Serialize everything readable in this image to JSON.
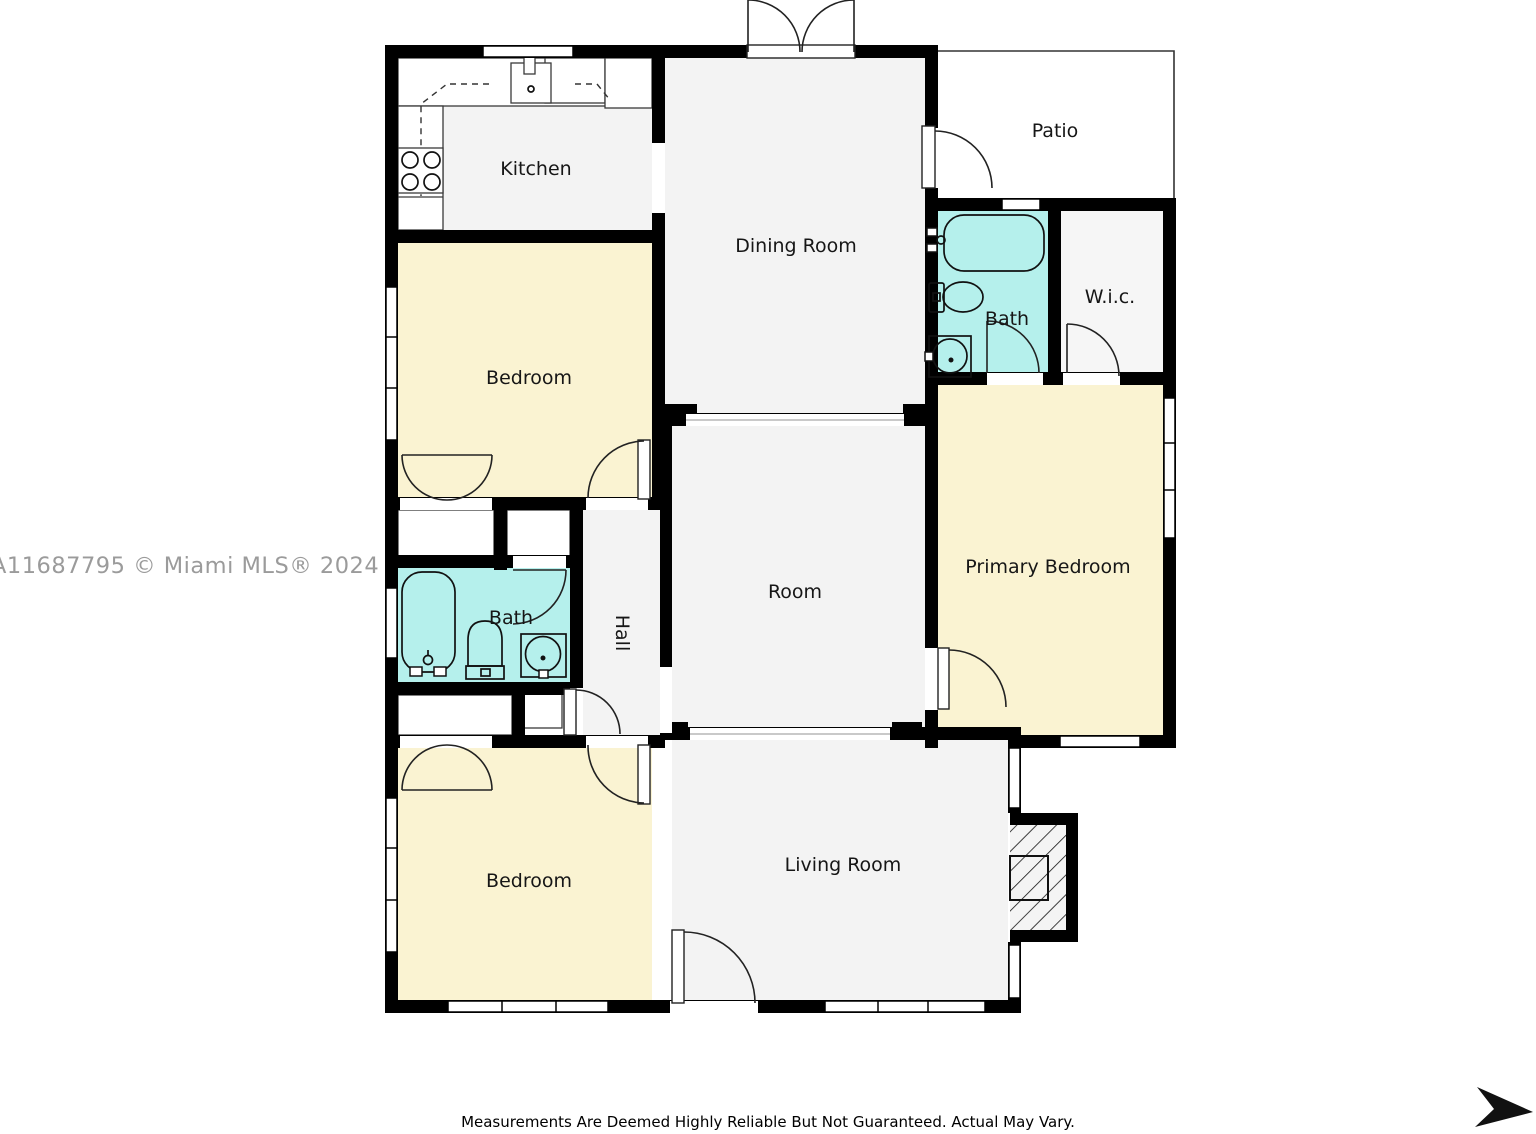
{
  "watermark": "A11687795 © Miami MLS® 2024",
  "disclaimer": "Measurements Are Deemed Highly Reliable But Not Guaranteed. Actual May Vary.",
  "rooms": {
    "kitchen": "Kitchen",
    "dining_room": "Dining Room",
    "patio": "Patio",
    "bath_upper": "Bath",
    "wic": "W.i.c.",
    "bedroom_upper": "Bedroom",
    "primary_bedroom": "Primary Bedroom",
    "room": "Room",
    "bath_lower": "Bath",
    "hall": "Hall",
    "bedroom_lower": "Bedroom",
    "living_room": "Living Room"
  },
  "icons": {
    "stove": "stove-icon",
    "kitchen_sink": "kitchen-sink-icon",
    "bathtub": "bathtub-icon",
    "toilet": "toilet-icon",
    "washbasin": "washbasin-icon",
    "fireplace": "fireplace-icon",
    "door_swing": "door-swing-icon",
    "window": "window-icon",
    "arrow": "arrow-icon"
  },
  "colors": {
    "wall": "#000000",
    "floor_gray": "#f3f3f3",
    "bedroom_yellow": "#faf3d2",
    "bath_cyan": "#b5f0ec",
    "wic_gray": "#f6f6f6",
    "watermark_gray": "#9b9b9b",
    "background": "#ffffff"
  }
}
